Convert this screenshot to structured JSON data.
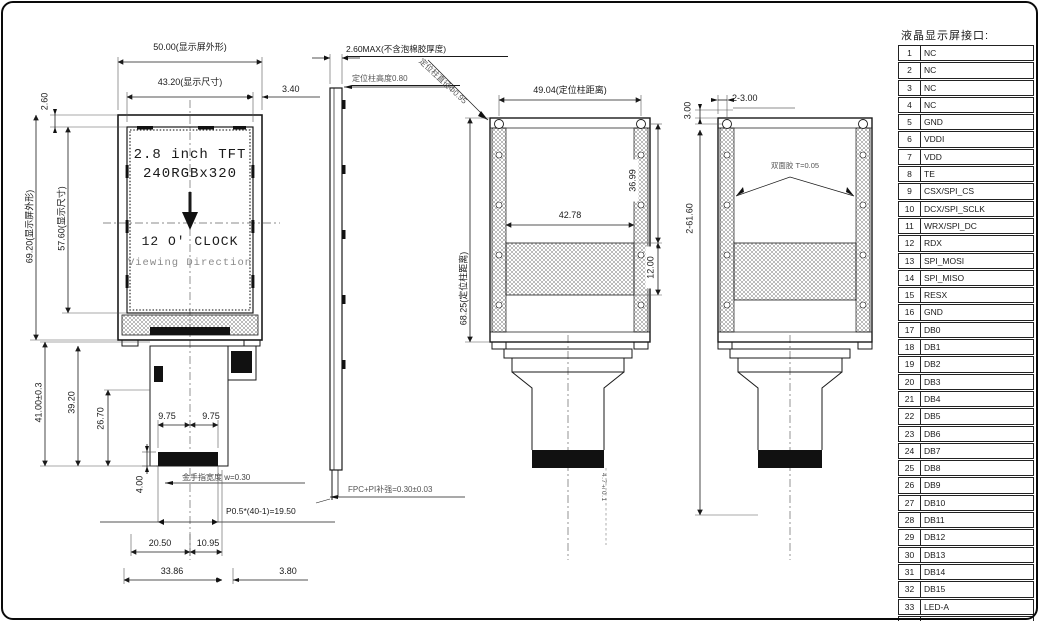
{
  "front_view": {
    "dim_50": "50.00(显示屏外形)",
    "dim_43_2": "43.20(显示尺寸)",
    "dim_3_4": "3.40",
    "dim_2_6": "2.60",
    "dim_69_2": "69.20(显示屏外形)",
    "dim_57_6": "57.60(显示尺寸)",
    "screen_line1": "2.8 inch TFT",
    "screen_line2": "240RGBx320",
    "screen_line3": "12 O' CLOCK",
    "screen_line4": "Viewing Direction",
    "dim_41": "41.00±0.3",
    "dim_39_2": "39.20",
    "dim_26_7": "26.70",
    "dim_9_75_l": "9.75",
    "dim_9_75_r": "9.75",
    "dim_4": "4.00",
    "gold_finger_note": "金手指宽度 w=0.30",
    "pitch_note": "P0.5*(40-1)=19.50",
    "dim_20_5": "20.50",
    "dim_10_95": "10.95",
    "dim_33_86": "33.86",
    "dim_3_8": "3.80"
  },
  "side_view": {
    "dim_thickness_max": "2.60MAX(不含泡棉胶厚度)",
    "pillar_height_note": "定位柱高度0.80",
    "pillar_dia_note": "定位柱直径Φ0.95",
    "fpc_note": "FPC+PI补强=0.30±0.03"
  },
  "back_view1": {
    "dim_49_04": "49.04(定位柱距离)",
    "dim_68_25": "68.25(定位柱距离)",
    "dim_36_99": "36.99",
    "dim_42_78": "42.78",
    "dim_12_00": "12.00",
    "tail_note": "4.7±0.1"
  },
  "back_view2": {
    "dim_2_3_00": "2-3.00",
    "dim_3_00": "3.00",
    "dim_2_61_60": "2-61.60",
    "tape_note": "双面胶 T=0.05"
  },
  "pin_table": {
    "title": "液晶显示屏接口:",
    "pins": [
      {
        "no": "1",
        "name": "NC"
      },
      {
        "no": "2",
        "name": "NC"
      },
      {
        "no": "3",
        "name": "NC"
      },
      {
        "no": "4",
        "name": "NC"
      },
      {
        "no": "5",
        "name": "GND"
      },
      {
        "no": "6",
        "name": "VDDI"
      },
      {
        "no": "7",
        "name": "VDD"
      },
      {
        "no": "8",
        "name": "TE"
      },
      {
        "no": "9",
        "name": "CSX/SPI_CS"
      },
      {
        "no": "10",
        "name": "DCX/SPI_SCLK"
      },
      {
        "no": "11",
        "name": "WRX/SPI_DC"
      },
      {
        "no": "12",
        "name": "RDX"
      },
      {
        "no": "13",
        "name": "SPI_MOSI"
      },
      {
        "no": "14",
        "name": "SPI_MISO"
      },
      {
        "no": "15",
        "name": "RESX"
      },
      {
        "no": "16",
        "name": "GND"
      },
      {
        "no": "17",
        "name": "DB0"
      },
      {
        "no": "18",
        "name": "DB1"
      },
      {
        "no": "19",
        "name": "DB2"
      },
      {
        "no": "20",
        "name": "DB3"
      },
      {
        "no": "21",
        "name": "DB4"
      },
      {
        "no": "22",
        "name": "DB5"
      },
      {
        "no": "23",
        "name": "DB6"
      },
      {
        "no": "24",
        "name": "DB7"
      },
      {
        "no": "25",
        "name": "DB8"
      },
      {
        "no": "26",
        "name": "DB9"
      },
      {
        "no": "27",
        "name": "DB10"
      },
      {
        "no": "28",
        "name": "DB11"
      },
      {
        "no": "29",
        "name": "DB12"
      },
      {
        "no": "30",
        "name": "DB13"
      },
      {
        "no": "31",
        "name": "DB14"
      },
      {
        "no": "32",
        "name": "DB15"
      },
      {
        "no": "33",
        "name": "LED-A"
      },
      {
        "no": "34",
        "name": "LED-K"
      },
      {
        "no": "35",
        "name": "LED-K"
      }
    ]
  }
}
